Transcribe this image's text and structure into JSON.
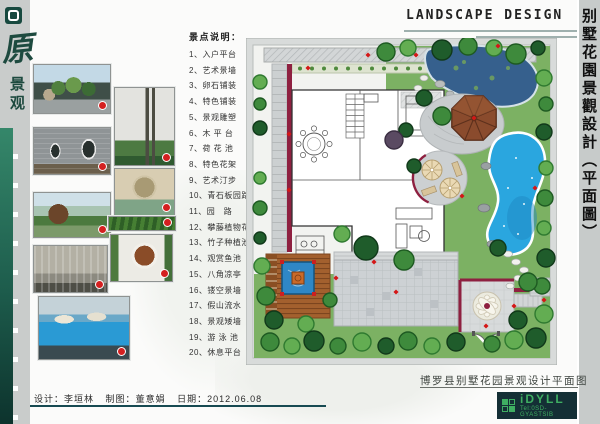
{
  "brand": {
    "logo_char": "原",
    "logo_sub": "景观"
  },
  "header": {
    "title_en": "LANDSCAPE DESIGN",
    "title_cn_vertical": "别墅花園景觀設計（平面圖）"
  },
  "legend": {
    "title": "景点说明：",
    "items": [
      "1、入户平台",
      "2、艺术景墙",
      "3、卵石铺装",
      "4、特色铺装",
      "5、景观雕塑",
      "6、木 平 台",
      "7、荷 花 池",
      "8、特色花架",
      "9、艺术汀步",
      "10、青石板园路",
      "11、园　路",
      "12、攀藤植物花池",
      "13、竹子种植池",
      "14、观赏鱼池",
      "15、八角凉亭",
      "16、镂空景墙",
      "17、假山流水",
      "18、景观矮墙",
      "19、游 泳 池",
      "20、休息平台"
    ]
  },
  "footer": {
    "credits": [
      {
        "label": "设计：",
        "value": "李垣林"
      },
      {
        "label": "制图：",
        "value": "董意娟"
      },
      {
        "label": "日期：",
        "value": "2012.06.08"
      }
    ],
    "drawing_title": "博罗县别墅花园景观设计平面图"
  },
  "logo_block": {
    "brand_name": "iDYLL",
    "tel": "Tel:0SD-GYASTSIB"
  },
  "colors": {
    "accent_green": "#2e7d5f",
    "deep_teal": "#174a52",
    "maroon": "#8e2040",
    "pool_blue": "#2aa6df",
    "pond_blue": "#36608d",
    "logo_green": "#3fae62"
  }
}
